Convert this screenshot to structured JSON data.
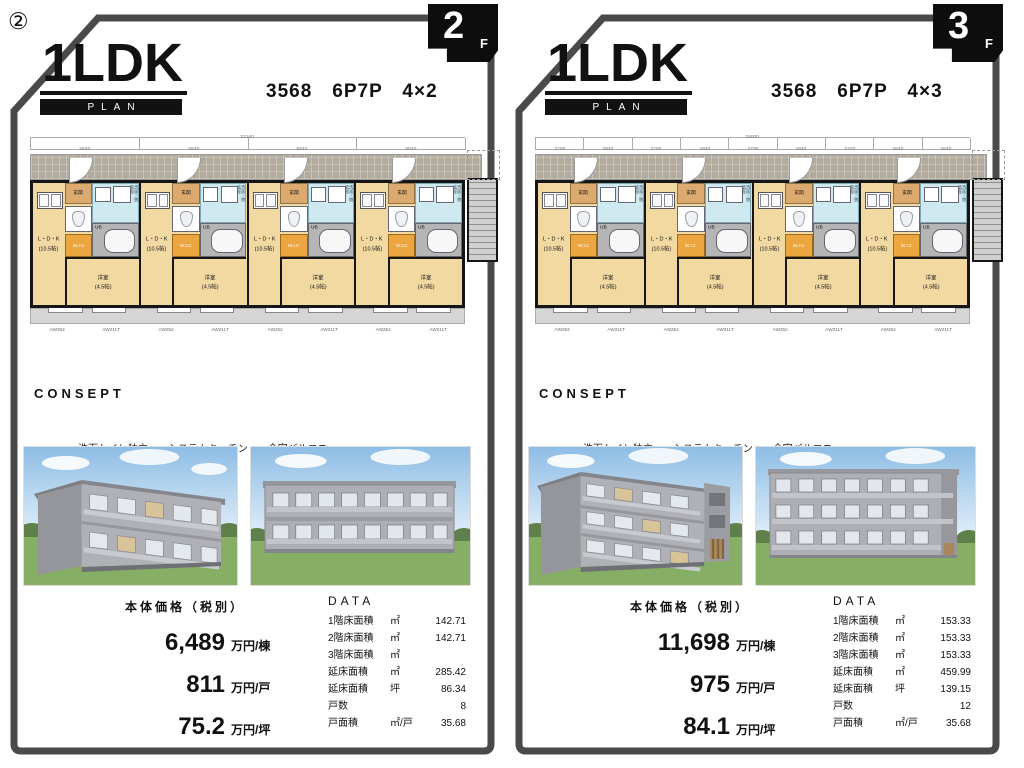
{
  "page": {
    "number_label": "②"
  },
  "palette": {
    "frame": "#4a4a4a",
    "ink": "#111111",
    "floor_tan": "#f2d9a2",
    "wic_orange": "#eca63f",
    "wash_blue": "#cfe9f1",
    "bath_gray": "#b5b5b5",
    "corridor_gray": "#b2aa9c",
    "balcony_gray": "#d6d6d6",
    "grass_green": "#86ae64",
    "sky_blue": "#9cc4e8",
    "building_gray": "#aeafb4"
  },
  "floorplan": {
    "ldk_label": "L・D・K",
    "ldk_size": "(10.5帖)",
    "wic_label": "W.I.C",
    "bedroom_label": "洋室",
    "bedroom_size": "(4.5帖)",
    "entrance_label": "玄関",
    "bath_label": "UB",
    "wash_label": "洗面・脱衣室"
  },
  "panels": [
    {
      "floor_badge": {
        "number": "2",
        "suffix": "F"
      },
      "title": "1LDK",
      "plan_label": "PLAN",
      "spec": "3568　6P7P　4×2",
      "dimensions": {
        "total": "22160",
        "segments": [
          "5540",
          "5540",
          "5540",
          "5540"
        ]
      },
      "window_labels": [
        "AW252",
        "AW211T",
        "AW252",
        "AW211T",
        "AW252",
        "AW211T",
        "AW252",
        "AW211T"
      ],
      "consept": {
        "heading": "CONSEPT",
        "features_line1": "洗面トイレ独立　　システムキッチン　　全室バルコニー",
        "features_line2": "外部コンクリート階段"
      },
      "price": {
        "heading": "本体価格（税別）",
        "rows": [
          {
            "value": "6,489",
            "unit": "万円/棟"
          },
          {
            "value": "811",
            "unit": "万円/戸"
          },
          {
            "value": "75.2",
            "unit": "万円/坪"
          }
        ]
      },
      "data": {
        "heading": "DATA",
        "rows": [
          {
            "label": "1階床面積",
            "unit": "㎡",
            "value": "142.71"
          },
          {
            "label": "2階床面積",
            "unit": "㎡",
            "value": "142.71"
          },
          {
            "label": "3階床面積",
            "unit": "㎡",
            "value": ""
          },
          {
            "label": "延床面積",
            "unit": "㎡",
            "value": "285.42"
          },
          {
            "label": "延床面積",
            "unit": "坪",
            "value": "86.34"
          },
          {
            "label": "戸数",
            "unit": "",
            "value": "8"
          },
          {
            "label": "戸面積",
            "unit": "㎡/戸",
            "value": "35.68"
          }
        ]
      }
    },
    {
      "floor_badge": {
        "number": "3",
        "suffix": "F"
      },
      "title": "1LDK",
      "plan_label": "PLAN",
      "spec": "3568　6P7P　4×3",
      "dimensions": {
        "total": "25000",
        "segments": [
          "2700",
          "2840",
          "2700",
          "2840",
          "2700",
          "2840",
          "2700",
          "2840",
          "2840"
        ]
      },
      "window_labels": [
        "AW252",
        "AW211T",
        "AW252",
        "AW211T",
        "AW252",
        "AW211T",
        "AW252",
        "AW211T"
      ],
      "consept": {
        "heading": "CONSEPT",
        "features_line1": "洗面トイレ独立　　システムキッチン　　全室バルコニー",
        "features_line2": "エントランス階段室　　鉄骨階段"
      },
      "price": {
        "heading": "本体価格（税別）",
        "rows": [
          {
            "value": "11,698",
            "unit": "万円/棟"
          },
          {
            "value": "975",
            "unit": "万円/戸"
          },
          {
            "value": "84.1",
            "unit": "万円/坪"
          }
        ]
      },
      "data": {
        "heading": "DATA",
        "rows": [
          {
            "label": "1階床面積",
            "unit": "㎡",
            "value": "153.33"
          },
          {
            "label": "2階床面積",
            "unit": "㎡",
            "value": "153.33"
          },
          {
            "label": "3階床面積",
            "unit": "㎡",
            "value": "153.33"
          },
          {
            "label": "延床面積",
            "unit": "㎡",
            "value": "459.99"
          },
          {
            "label": "延床面積",
            "unit": "坪",
            "value": "139.15"
          },
          {
            "label": "戸数",
            "unit": "",
            "value": "12"
          },
          {
            "label": "戸面積",
            "unit": "㎡/戸",
            "value": "35.68"
          }
        ]
      }
    }
  ]
}
